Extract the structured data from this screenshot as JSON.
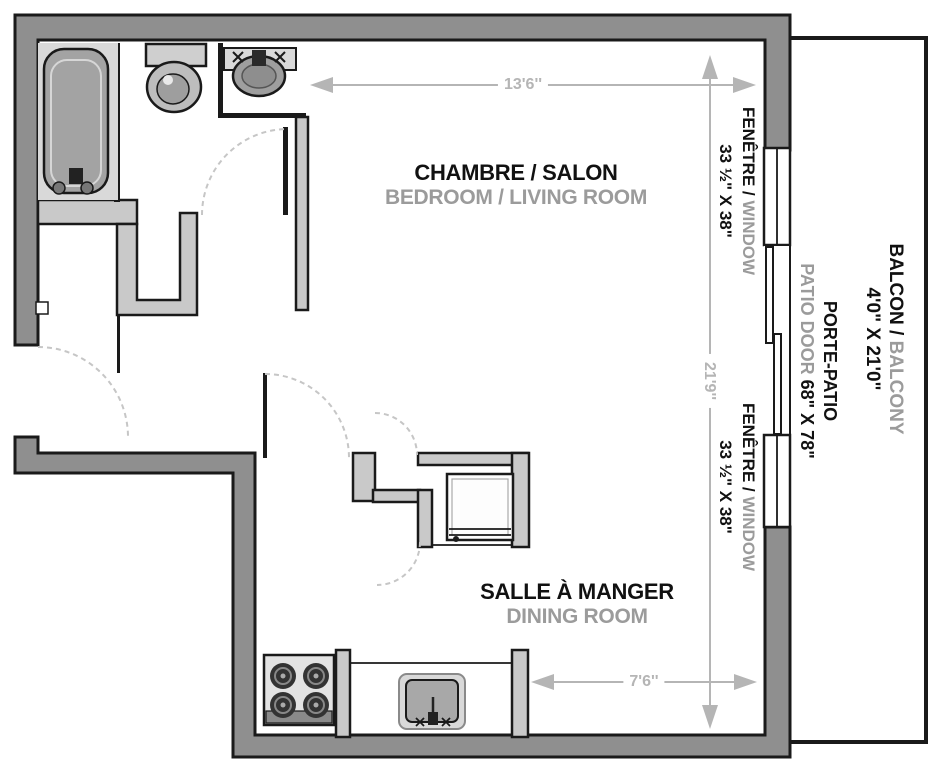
{
  "floorplan": {
    "rooms": {
      "bedroom_living": {
        "fr": "CHAMBRE / SALON",
        "en": "BEDROOM / LIVING ROOM"
      },
      "dining": {
        "fr": "SALLE À MANGER",
        "en": "DINING ROOM"
      }
    },
    "features": {
      "window": {
        "fr": "FENÊTRE /",
        "en": "WINDOW",
        "size": "33 ½\" X 38\""
      },
      "patio_door": {
        "fr": "PORTE-PATIO",
        "en": "PATIO DOOR",
        "size": "68\" X 78\""
      },
      "balcony": {
        "fr": "BALCON /",
        "en": "BALCONY",
        "size": "4'0\" X 21'0\""
      }
    },
    "dimensions": {
      "top_width": "13'6''",
      "right_height": "21'9''",
      "bottom_width": "7'6''"
    },
    "fixtures": [
      "bathtub",
      "toilet",
      "vanity-sink",
      "refrigerator",
      "stove",
      "kitchen-sink"
    ],
    "colors": {
      "exterior_wall": "#8f8f8f",
      "interior_wall": "#c9c9c9",
      "outline": "#1a1a1a",
      "fixture_gray": "#9e9e9e",
      "fixture_light": "#d9d9d9",
      "dimension_gray": "#b5b5b5",
      "label_secondary": "#9b9b9b",
      "label_primary": "#111111"
    }
  }
}
